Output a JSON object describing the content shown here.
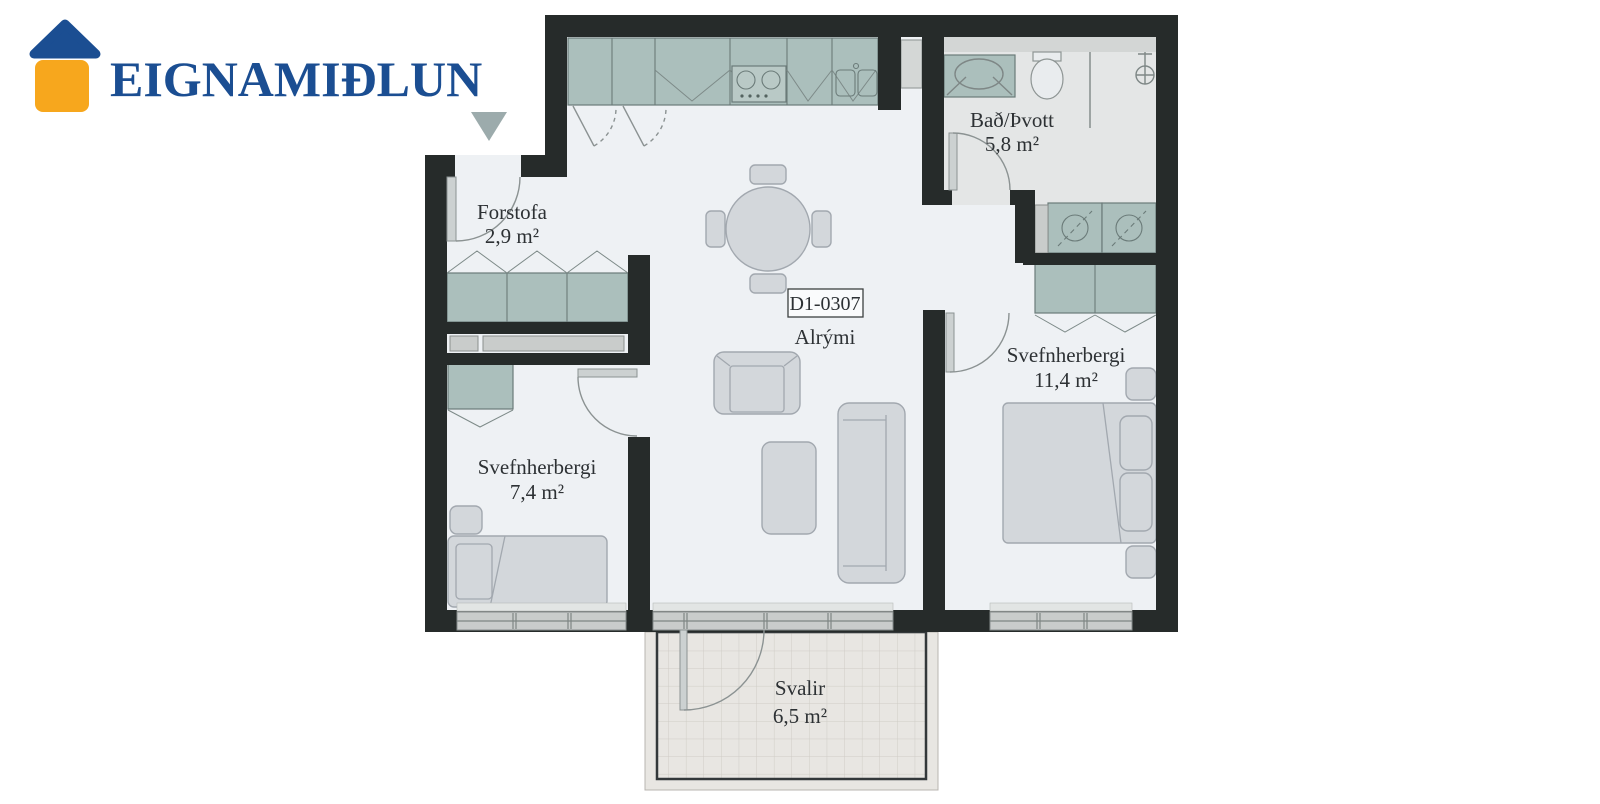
{
  "logo": {
    "text": "EIGNAMIÐLUN",
    "brand_blue": "#1b4e92",
    "brand_orange": "#f7a71d",
    "icon": "house-logo-icon"
  },
  "floorplan": {
    "unit_label": "D1-0307",
    "rooms": [
      {
        "id": "forstofa",
        "name": "Forstofa",
        "area": "2,9 m²"
      },
      {
        "id": "bad",
        "name": "Bað/Þvott",
        "area": "5,8 m²"
      },
      {
        "id": "alrymi",
        "name": "Alrými",
        "area": ""
      },
      {
        "id": "svefn1",
        "name": "Svefnherbergi",
        "area": "7,4 m²"
      },
      {
        "id": "svefn2",
        "name": "Svefnherbergi",
        "area": "11,4 m²"
      },
      {
        "id": "svalir",
        "name": "Svalir",
        "area": "6,5 m²"
      }
    ],
    "icons": {
      "entrance": "entrance-arrow-down-icon"
    },
    "colors": {
      "wall": "#262b2a",
      "floor": "#eef1f4",
      "bath_floor": "#e4e6e6",
      "cabinet": "#abbfbc",
      "furniture": "#d3d7db",
      "balcony": "#e8e6e2",
      "window": "#c9cccb",
      "entrance_arrow": "#9cabac"
    }
  }
}
